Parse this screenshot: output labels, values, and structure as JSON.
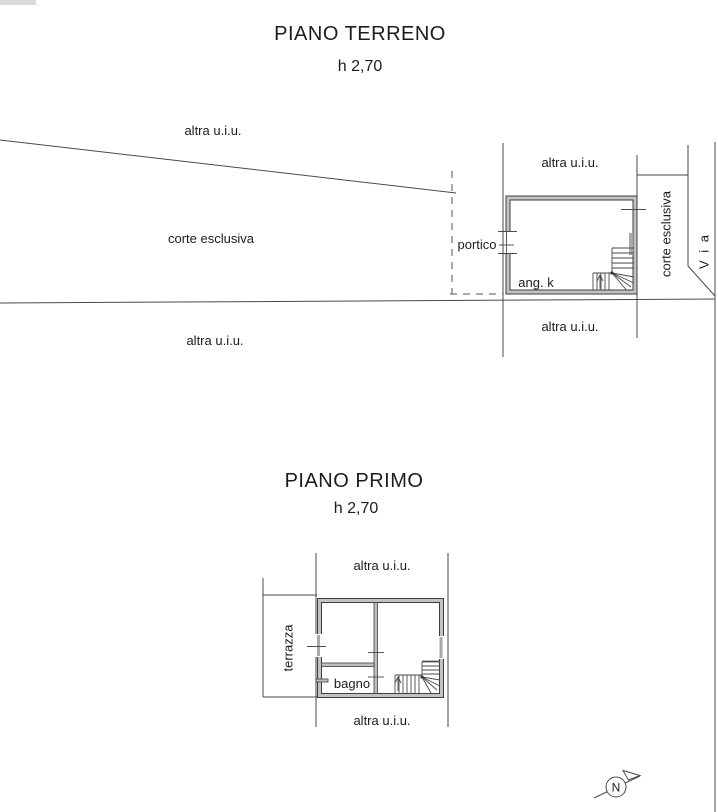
{
  "ground_floor": {
    "title": "PIANO TERRENO",
    "height_note": "h 2,70",
    "labels": {
      "altra_uiu": "altra u.i.u.",
      "corte_esclusiva": "corte esclusiva",
      "portico": "portico",
      "room": "ang. k",
      "via": "V i a"
    }
  },
  "first_floor": {
    "title": "PIANO PRIMO",
    "height_note": "h 2,70",
    "labels": {
      "altra_uiu": "altra u.i.u.",
      "terrazza": "terrazza",
      "bagno": "bagno"
    }
  },
  "compass": {
    "north": "N"
  },
  "colors": {
    "background": "#ffffff",
    "line": "#4a4a4a",
    "wall_fill": "#bfbfbf",
    "window_fill": "#aaaaaa",
    "text": "#1c1c1c"
  }
}
